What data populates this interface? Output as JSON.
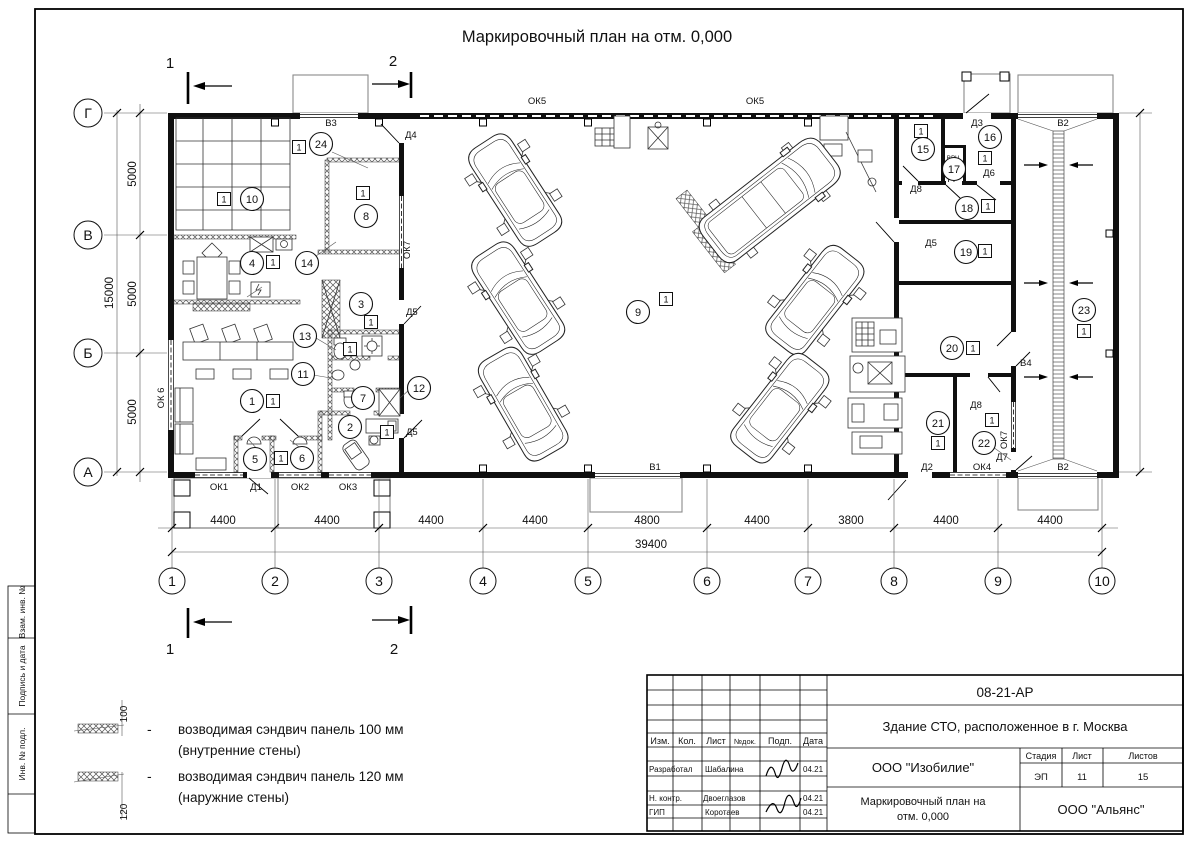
{
  "sheet": {
    "title": "Маркировочный план на отм. 0,000",
    "badge": "1"
  },
  "axes": {
    "cols": [
      "1",
      "2",
      "3",
      "4",
      "5",
      "6",
      "7",
      "8",
      "9",
      "10"
    ],
    "rows": [
      "Г",
      "В",
      "Б",
      "А"
    ]
  },
  "sections": {
    "m1": "1",
    "m2": "2"
  },
  "dims": {
    "bottom": [
      "4400",
      "4400",
      "4400",
      "4400",
      "4800",
      "4400",
      "3800",
      "4400",
      "4400"
    ],
    "bottom_total": "39400",
    "left": [
      "5000",
      "5000",
      "5000"
    ],
    "left_total": "15000"
  },
  "rooms": [
    "1",
    "2",
    "3",
    "4",
    "5",
    "6",
    "7",
    "8",
    "9",
    "10",
    "11",
    "12",
    "13",
    "14",
    "15",
    "16",
    "17",
    "18",
    "19",
    "20",
    "21",
    "22",
    "23",
    "24"
  ],
  "openings": {
    "v1": "В1",
    "v2": "В2",
    "v3": "В3",
    "v4": "В4",
    "d1": "Д1",
    "d2": "Д2",
    "d3": "Д3",
    "d4": "Д4",
    "d5": "Д5",
    "d6": "Д6",
    "d7": "Д7",
    "d8": "Д8",
    "d9": "Д9",
    "ok1": "ОК1",
    "ok2": "ОК2",
    "ok3": "ОК3",
    "ok4": "ОК4",
    "ok5": "ОК5",
    "ok6": "ОК 6",
    "ok7": "ОК7",
    "vvch": "ВВЧ"
  },
  "legend": {
    "dash": "-",
    "items": [
      {
        "dim": "100",
        "l1": "возводимая сэндвич панель 100 мм",
        "l2": "(внутренние стены)"
      },
      {
        "dim": "120",
        "l1": "возводимая сэндвич панель 120 мм",
        "l2": "(наружние стены)"
      }
    ]
  },
  "titleblock": {
    "code": "08-21-АР",
    "object": "Здание СТО, расположенное в г. Москва",
    "org": "ООО \"Изобилие\"",
    "stage_label": "Стадия",
    "sheet_label": "Лист",
    "sheets_label": "Листов",
    "stage": "ЭП",
    "sheet_no": "11",
    "sheets_total": "15",
    "doc_line1": "Маркировочный план на",
    "doc_line2": "отм. 0,000",
    "firm": "ООО \"Альянс\"",
    "cols": {
      "izm": "Изм.",
      "kol": "Кол.",
      "list": "Лист",
      "ndoc": "№док.",
      "podp": "Подп.",
      "data": "Дата"
    },
    "rows": [
      {
        "role": "Разработал",
        "name": "Шабалина",
        "date": "04.21"
      },
      {
        "role": "Н. контр.",
        "name": "Двоеглазов",
        "date": "04.21"
      },
      {
        "role": "ГИП",
        "name": "Коротаев",
        "date": "04.21"
      }
    ]
  },
  "sidebar": {
    "b1": "Взам. инв. №",
    "b2": "Подпись и дата",
    "b3": "Инв. № подл."
  }
}
